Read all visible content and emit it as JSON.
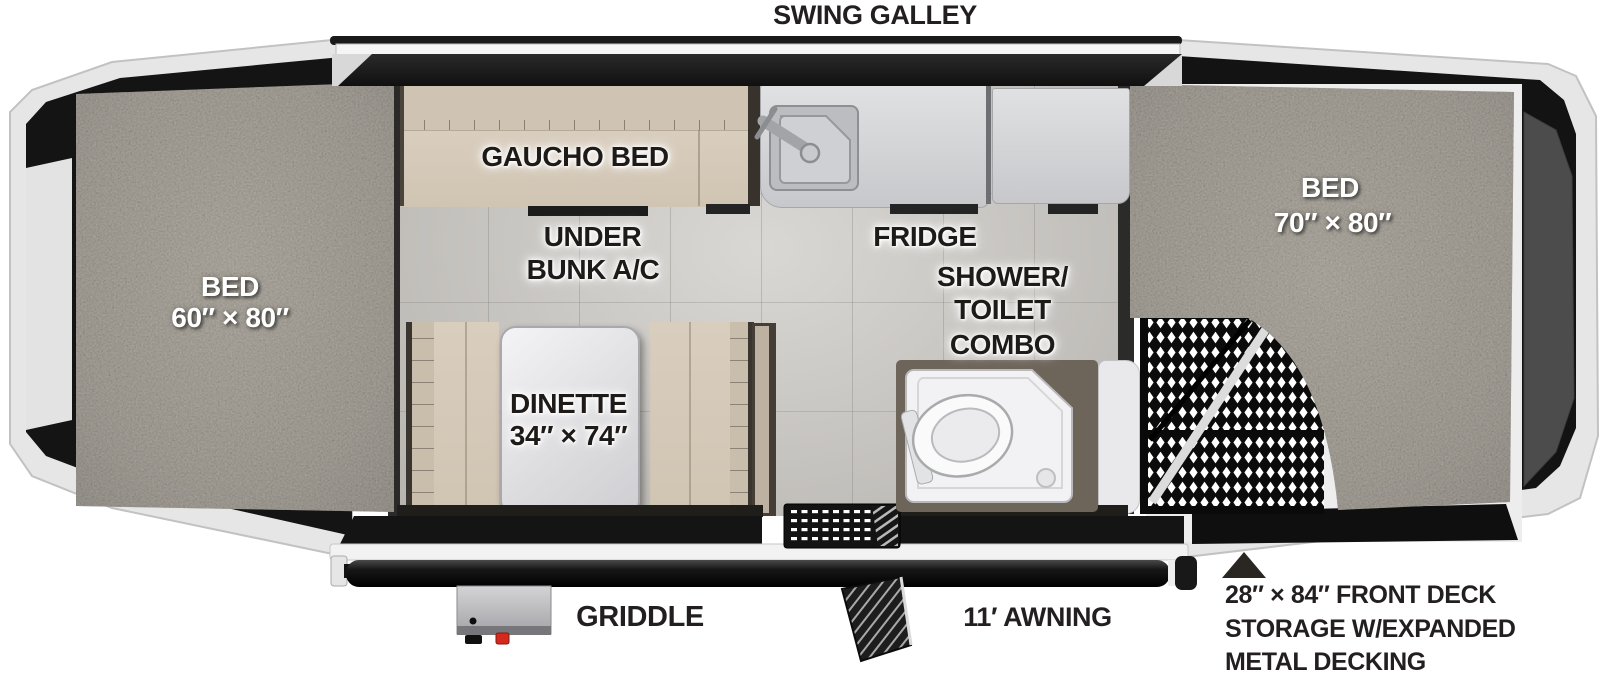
{
  "labels": {
    "swing_galley": "SWING GALLEY",
    "bed_left_1": "BED",
    "bed_left_2": "60″ × 80″",
    "gaucho_bed": "GAUCHO BED",
    "under_bunk_1": "UNDER",
    "under_bunk_2": "BUNK A/C",
    "fridge": "FRIDGE",
    "shower_1": "SHOWER/",
    "shower_2": "TOILET",
    "shower_3": "COMBO",
    "dinette_1": "DINETTE",
    "dinette_2": "34″ × 74″",
    "bed_right_1": "BED",
    "bed_right_2": "70″ × 80″",
    "griddle": "GRIDDLE",
    "awning": "11′ AWNING",
    "deck_note_1": "28″ × 84″ FRONT DECK",
    "deck_note_2": "STORAGE W/EXPANDED",
    "deck_note_3": "METAL DECKING"
  },
  "colors": {
    "carpet": "#857e71",
    "floor_tile": "#cbc8c3",
    "upholstery": "#d7ccbc",
    "counter": "#d6d7da",
    "frame_black": "#141414",
    "accent_red": "#d42a1e"
  }
}
